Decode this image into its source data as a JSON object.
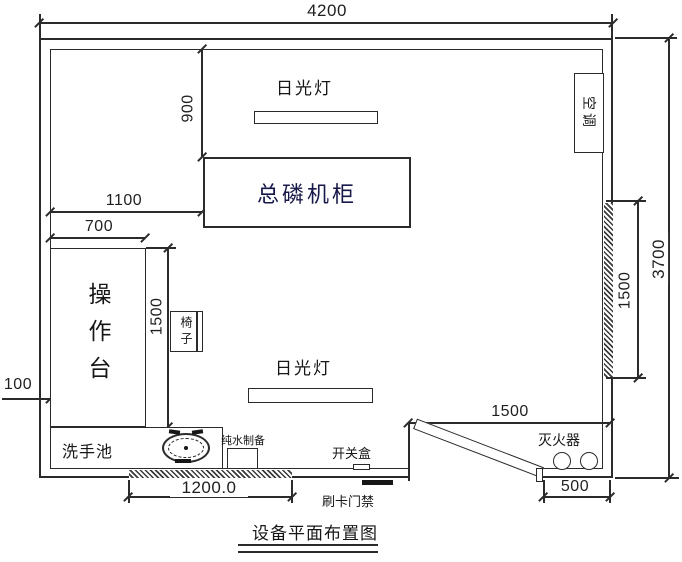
{
  "diagram_title": "设备平面布置图",
  "dimensions": {
    "room_width": "4200",
    "room_height": "3700",
    "lamp_offset_vertical": "900",
    "cabinet_offset_left": "1100",
    "worktable_width": "700",
    "worktable_length": "1500",
    "left_wall_gap": "100",
    "bottom_window_width": "1200.0",
    "door_area_width": "1500",
    "right_window_height": "1500",
    "door_side_wall": "500"
  },
  "labels": {
    "fluorescent_lamp_top": "日光灯",
    "fluorescent_lamp_bottom": "日光灯",
    "phosphorus_cabinet": "总磷机柜",
    "air_conditioner": "空调",
    "worktable": "操作台",
    "chair": "椅子",
    "wash_basin": "洗手池",
    "pure_water_prep": "纯水制备",
    "switch_box": "开关盒",
    "card_access": "刷卡门禁",
    "fire_extinguisher": "灭火器"
  },
  "colors": {
    "line": "#2b2b2b",
    "cabinet_text": "#17174a",
    "background": "#ffffff"
  }
}
